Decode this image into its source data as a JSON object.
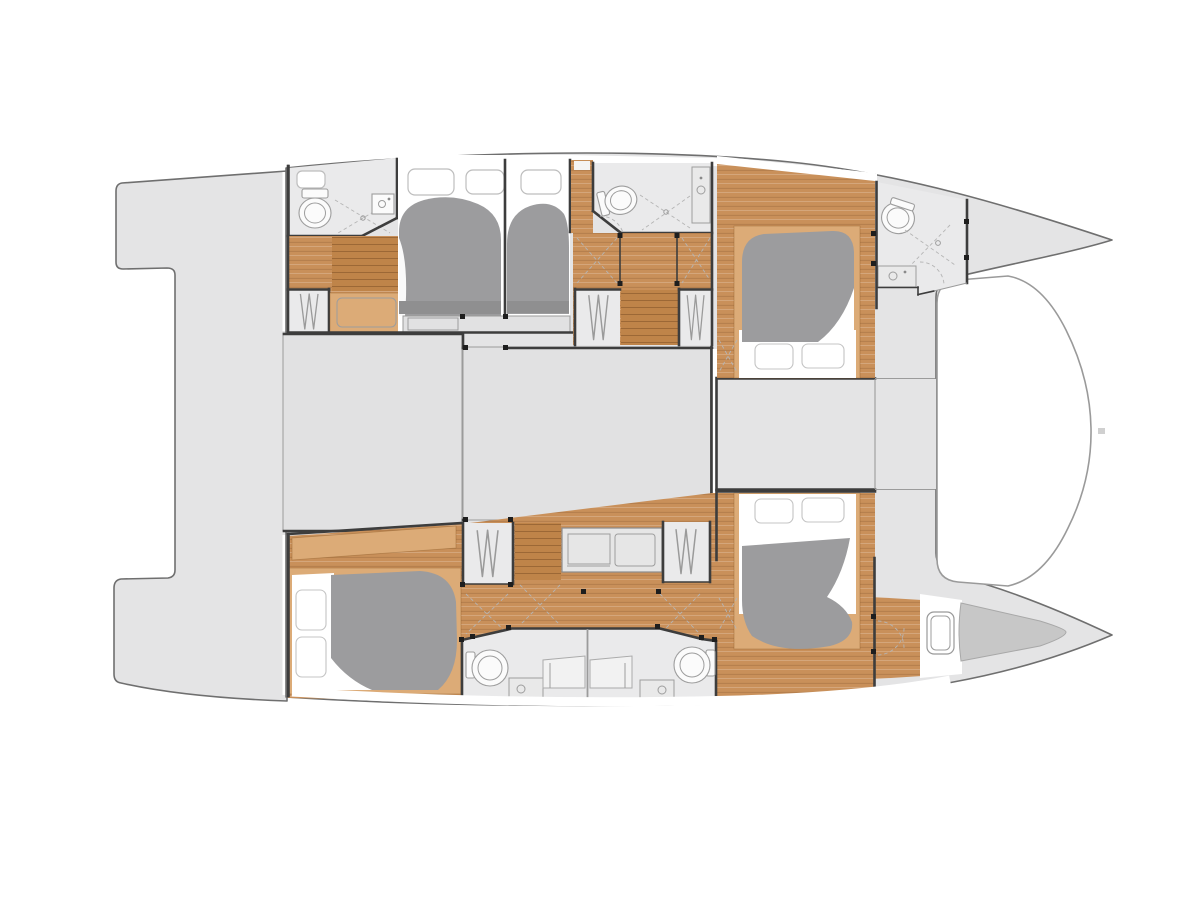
{
  "diagram": {
    "type": "boat-floor-plan",
    "subject": "catamaran yacht interior layout, plan view, bows pointing right",
    "hulls": [
      {
        "id": "port-hull",
        "position": "top",
        "rooms": [
          "aft-bathroom",
          "companionway-stairs",
          "aft-wardrobe",
          "aft-double-cabin",
          "mid-double-cabin",
          "mid-bathroom",
          "corridor-with-wardrobes",
          "forward-double-cabin",
          "bow-bathroom",
          "bow-deck"
        ]
      },
      {
        "id": "starboard-hull",
        "position": "bottom",
        "rooms": [
          "aft-double-cabin",
          "wardrobe",
          "companionway-stairs",
          "desk-vanity",
          "twin-central-bathrooms",
          "forward-double-cabin",
          "forepeak-berth",
          "bow-deck"
        ]
      }
    ],
    "shared_areas": [
      "aft-platform-and-cockpit",
      "saloon-block-aft",
      "saloon-block-forward",
      "foredeck-band",
      "trampoline"
    ],
    "counts": {
      "double_berths": 5,
      "pillows": 6,
      "bathrooms": 5,
      "toilets": 5,
      "sinks": 5,
      "showers": 5,
      "wardrobes": 6,
      "hull_windows": 4,
      "deck_hatches": 1,
      "stairways": 3
    },
    "icons": [
      "toilet-icon",
      "sink-icon",
      "shower-icon",
      "wardrobe-hangers-icon",
      "bed-duvet",
      "pillow",
      "window",
      "hatch-icon",
      "stairs-icon",
      "door-hinge-dot",
      "door-swing-dashes",
      "trampoline",
      "forestay-fitting"
    ],
    "colors": {
      "bg": "#ffffff",
      "deck": "#e4e4e5",
      "saloon": "#e1e1e2",
      "room": "#eaeaeb",
      "hullline": "#6f6f6f",
      "wall": "#3d3d3d",
      "wood": "#c9905a",
      "woodlight": "#dcab77",
      "stairs": "#bf8449",
      "duvet": "#9c9c9e",
      "duvetdark": "#8f8f90",
      "locker": "#c7c7c7",
      "trampline": "#9a9a9a",
      "hinge": "#1e1e1e"
    }
  }
}
